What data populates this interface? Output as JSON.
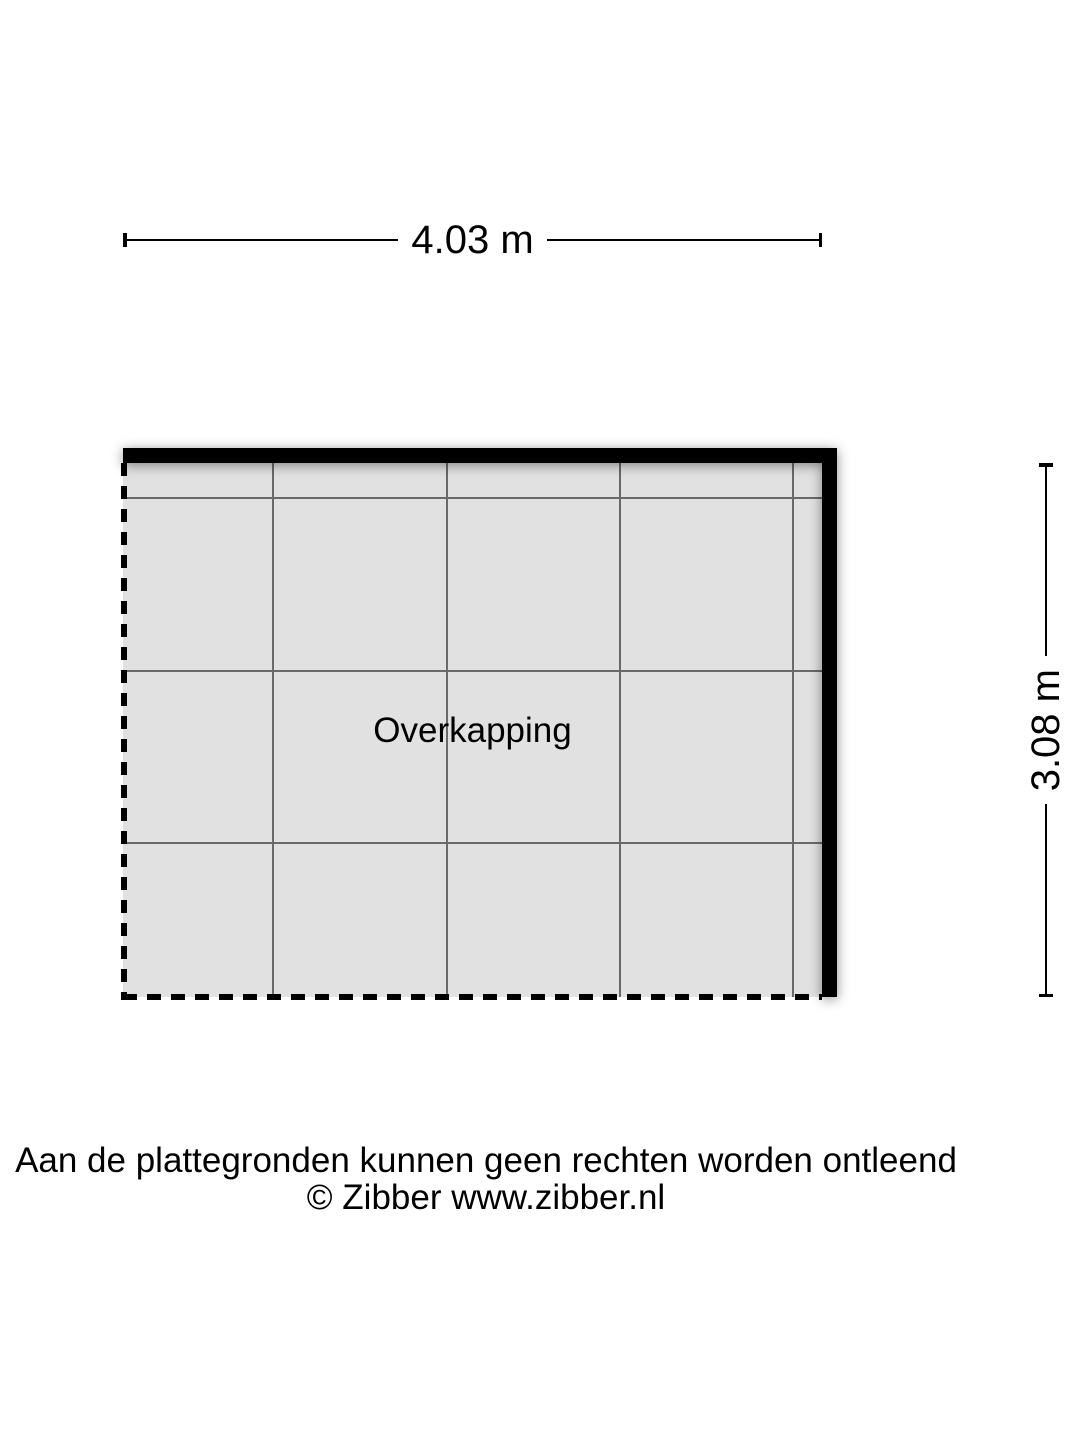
{
  "floorplan": {
    "room": {
      "label": "Overkapping"
    },
    "dimensions": {
      "width_label": "4.03 m",
      "height_label": "3.08 m",
      "width_m": 4.03,
      "height_m": 3.08
    }
  },
  "footer": {
    "disclaimer": "Aan de plattegronden kunnen geen rechten worden ontleend",
    "copyright": "© Zibber www.zibber.nl"
  },
  "colors": {
    "background": "#ffffff",
    "floor_fill": "#e1e1e1",
    "grid_line": "#696969",
    "wall": "#000000",
    "text": "#000000"
  }
}
